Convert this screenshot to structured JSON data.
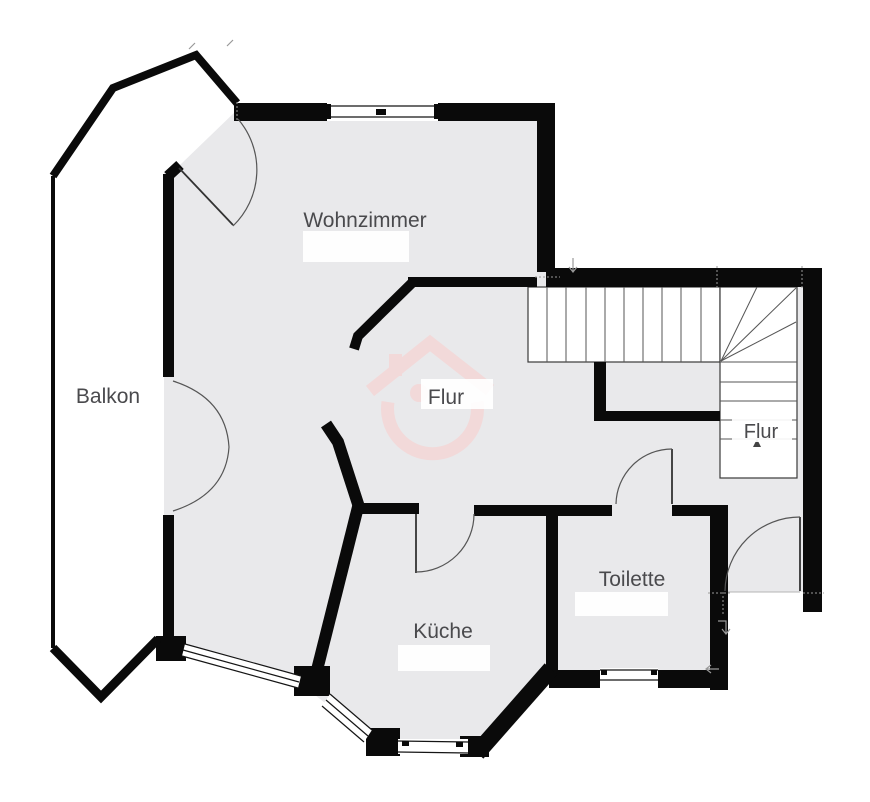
{
  "rooms": {
    "wohnzimmer": "Wohnzimmer",
    "balkon": "Balkon",
    "flur_center": "Flur",
    "flur_lower": "Flur",
    "kueche": "Küche",
    "toilette": "Toilette"
  },
  "colors": {
    "wall": "#0a0a0a",
    "floor": "#e9e9eb",
    "stair_line": "#565656",
    "watermark_pink": "#f2d9d9",
    "label_text": "#4a4a4d"
  },
  "icons": {
    "watermark": "house-logo-watermark"
  }
}
